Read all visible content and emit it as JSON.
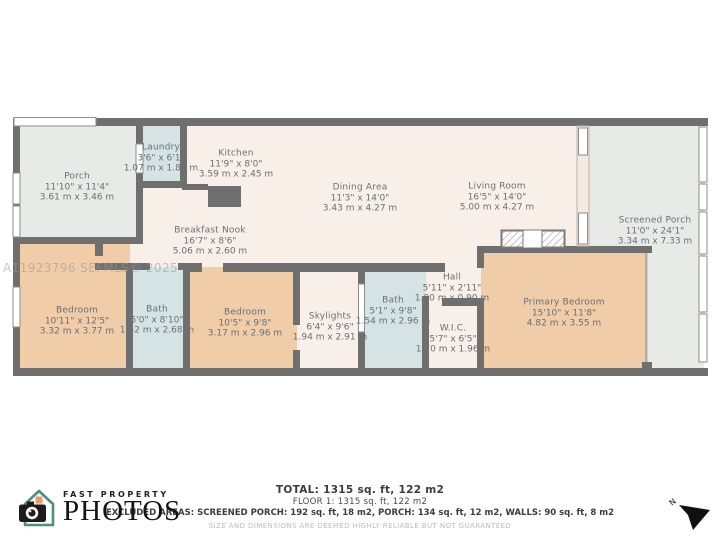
{
  "watermark": "A11923796  SEFMLS© 2025",
  "rooms": [
    {
      "name": "Porch",
      "imperial": "11'10\" x 11'4\"",
      "metric": "3.61 m x 3.46 m"
    },
    {
      "name": "Laundry",
      "imperial": "3'6\" x 6'1\"",
      "metric": "1.07 m x 1.85 m"
    },
    {
      "name": "Kitchen",
      "imperial": "11'9\" x 8'0\"",
      "metric": "3.59 m x 2.45 m"
    },
    {
      "name": "Dining Area",
      "imperial": "11'3\" x 14'0\"",
      "metric": "3.43 m x 4.27 m"
    },
    {
      "name": "Living Room",
      "imperial": "16'5\" x 14'0\"",
      "metric": "5.00 m x 4.27 m"
    },
    {
      "name": "Screened Porch",
      "imperial": "11'0\" x 24'1\"",
      "metric": "3.34 m x 7.33 m"
    },
    {
      "name": "Breakfast Nook",
      "imperial": "16'7\" x 8'6\"",
      "metric": "5.06 m x 2.60 m"
    },
    {
      "name": "Bedroom",
      "imperial": "10'11\" x 12'5\"",
      "metric": "3.32 m x 3.77 m"
    },
    {
      "name": "Bath",
      "imperial": "5'0\" x 8'10\"",
      "metric": "1.52 m x 2.68 m"
    },
    {
      "name": "Bedroom",
      "imperial": "10'5\" x 9'8\"",
      "metric": "3.17 m x 2.96 m"
    },
    {
      "name": "Skylights",
      "imperial": "6'4\" x 9'6\"",
      "metric": "1.94 m x 2.91 m"
    },
    {
      "name": "Bath",
      "imperial": "5'1\" x 9'8\"",
      "metric": "1.54 m x 2.96 m"
    },
    {
      "name": "Hall",
      "imperial": "5'11\" x 2'11\"",
      "metric": "1.80 m x 0.90 m"
    },
    {
      "name": "W.I.C.",
      "imperial": "5'7\" x 6'5\"",
      "metric": "1.70 m x 1.96 m"
    },
    {
      "name": "Primary Bedroom",
      "imperial": "15'10\" x 11'8\"",
      "metric": "4.82 m x 3.55 m"
    }
  ],
  "footer": {
    "total": "TOTAL: 1315 sq. ft, 122 m2",
    "floor": "FLOOR 1: 1315 sq. ft, 122 m2",
    "excluded": "EXCLUDED AREAS: SCREENED PORCH: 192 sq. ft, 18 m2, PORCH: 134 sq. ft, 12 m2, WALLS: 90 sq. ft, 8 m2",
    "disclaimer": "SIZE AND DIMENSIONS ARE DEEMED HIGHLY RELIABLE BUT NOT GUARANTEED"
  },
  "logo": {
    "line1": "FAST PROPERTY",
    "line2": "PHOTOS"
  },
  "compass": {
    "label": "N"
  },
  "colors": {
    "wall": "#6f6f6f",
    "floor_main": "#f8efe8",
    "floor_bedroom": "#f0cda8",
    "floor_bath": "#d5e3e4",
    "floor_porch": "#e8eae7",
    "label_text": "#6a6f77",
    "logo_teal": "#4e8d7f",
    "logo_orange": "#e89a6b"
  }
}
